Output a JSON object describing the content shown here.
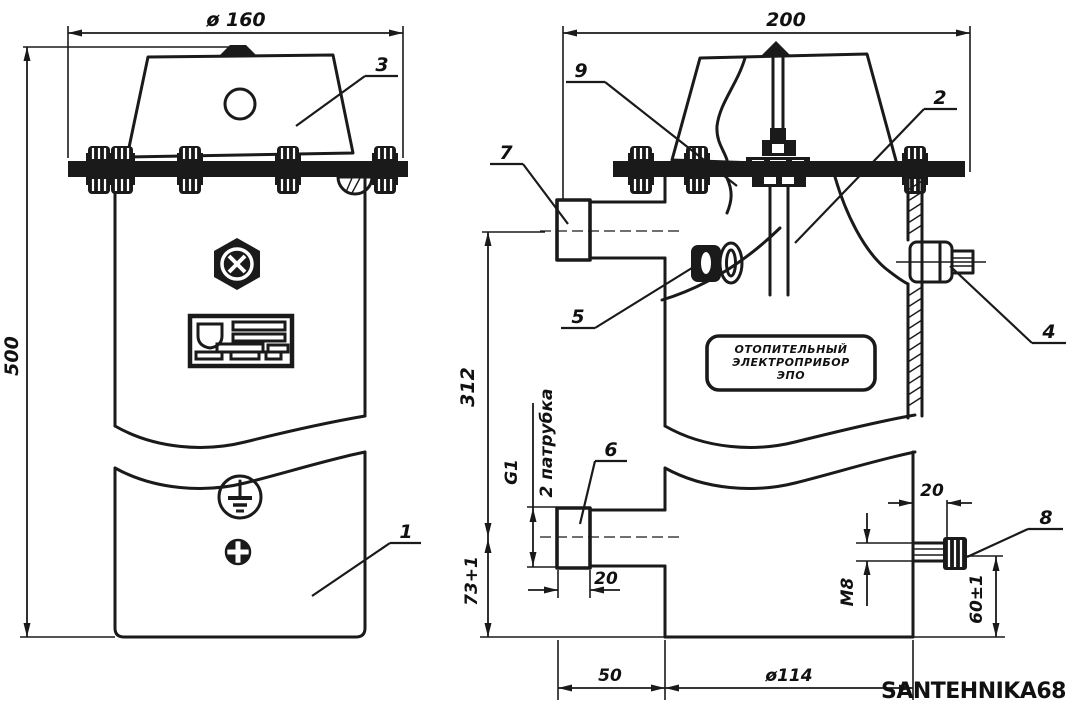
{
  "drawing": {
    "watermark": "SANTEHNIKA68",
    "nameplate_box": {
      "line1": "ОТОПИТЕЛЬНЫЙ",
      "line2": "ЭЛЕКТРОПРИБОР",
      "line3": "ЭПО"
    },
    "dims": {
      "flange_diameter": "ø 160",
      "total_height": "500",
      "side_width": "200",
      "pipe_axis_height": "312",
      "pipe_thread": "G1",
      "pipe_note": "2 патрубка",
      "pipe_bottom_offset": "73+1",
      "pipe_length": "20",
      "pipe_to_body": "50",
      "body_diameter": "ø114",
      "stud_length": "20",
      "stud_thread": "M8",
      "stud_height": "60±1"
    },
    "parts": {
      "body": "1",
      "heating_element": "2",
      "lid": "3",
      "outlet_fitting": "4",
      "plug": "5",
      "bottom_pipe": "6",
      "top_pipe": "7",
      "ground_stud": "8",
      "gasket": "9"
    }
  }
}
